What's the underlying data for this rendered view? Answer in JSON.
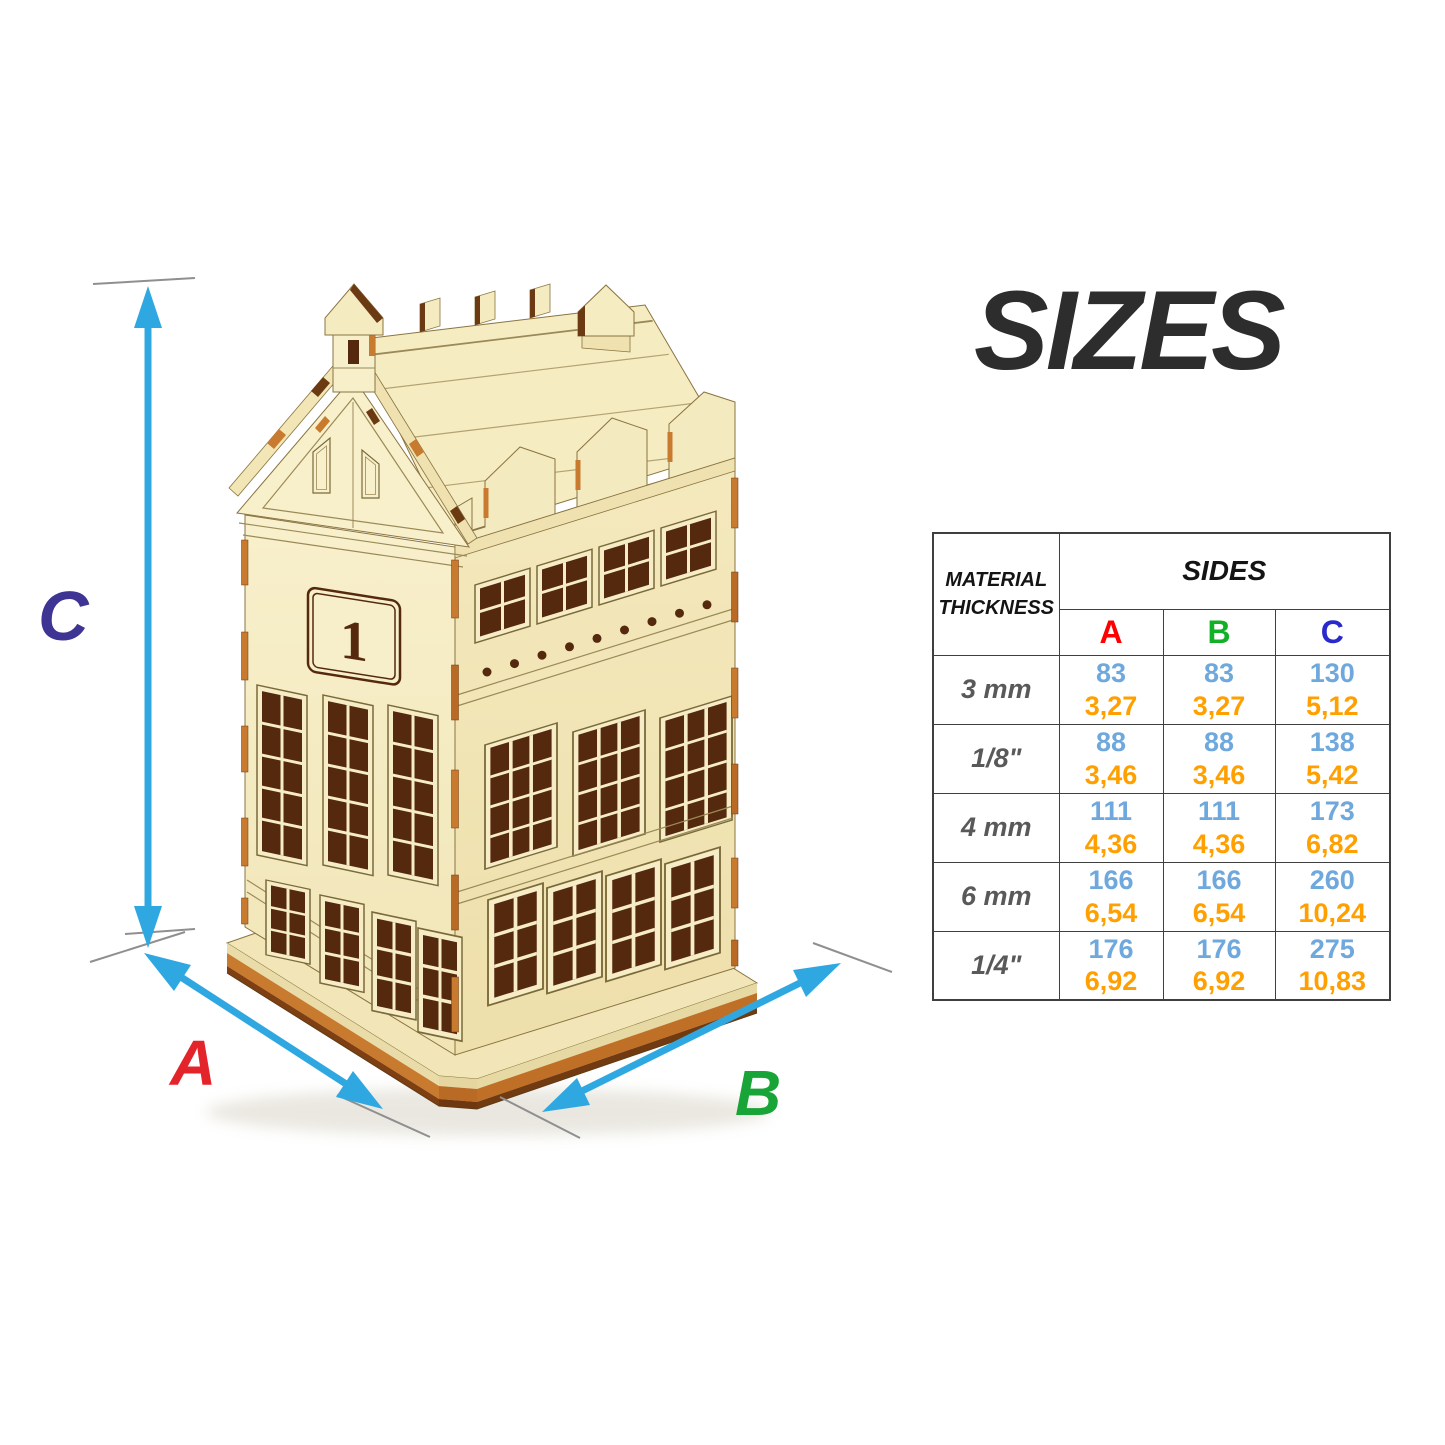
{
  "title": "SIZES",
  "diagram": {
    "house_number": "1",
    "label_a": "A",
    "label_b": "B",
    "label_c": "C",
    "label_colors": {
      "a": "#E3242B",
      "b": "#18A437",
      "c": "#3D3493"
    },
    "arrow_color": "#2FA8E1",
    "tick_color": "#8F8F8F"
  },
  "table": {
    "header": {
      "col1": "MATERIAL THICKNESS",
      "group": "SIDES",
      "sides": [
        {
          "label": "A",
          "color": "#FF0000"
        },
        {
          "label": "B",
          "color": "#12B025"
        },
        {
          "label": "C",
          "color": "#2929CC"
        }
      ]
    },
    "rows": [
      {
        "thickness": "3 mm",
        "values": [
          {
            "mm": "83",
            "inch": "3,27"
          },
          {
            "mm": "83",
            "inch": "3,27"
          },
          {
            "mm": "130",
            "inch": "5,12"
          }
        ]
      },
      {
        "thickness": "1/8\"",
        "values": [
          {
            "mm": "88",
            "inch": "3,46"
          },
          {
            "mm": "88",
            "inch": "3,46"
          },
          {
            "mm": "138",
            "inch": "5,42"
          }
        ]
      },
      {
        "thickness": "4 mm",
        "values": [
          {
            "mm": "111",
            "inch": "4,36"
          },
          {
            "mm": "111",
            "inch": "4,36"
          },
          {
            "mm": "173",
            "inch": "6,82"
          }
        ]
      },
      {
        "thickness": "6 mm",
        "values": [
          {
            "mm": "166",
            "inch": "6,54"
          },
          {
            "mm": "166",
            "inch": "6,54"
          },
          {
            "mm": "260",
            "inch": "10,24"
          }
        ]
      },
      {
        "thickness": "1/4\"",
        "values": [
          {
            "mm": "176",
            "inch": "6,92"
          },
          {
            "mm": "176",
            "inch": "6,92"
          },
          {
            "mm": "275",
            "inch": "10,83"
          }
        ]
      }
    ],
    "colors": {
      "mm": "#6FA8DC",
      "inch": "#FFA000",
      "thickness": "#595959",
      "border": "#3F3F3F"
    }
  }
}
